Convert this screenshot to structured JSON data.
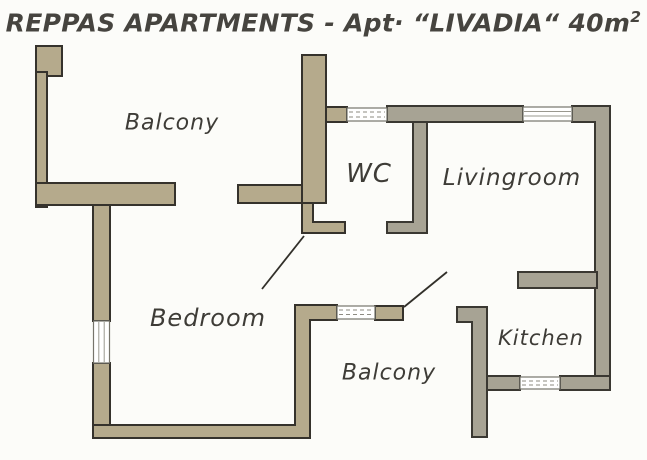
{
  "title": {
    "main": "REPPAS APARTMENTS - Apt· “LIVADIA“ 40m",
    "sup": "2"
  },
  "rooms": [
    {
      "id": "balcony-top",
      "label": "Balcony"
    },
    {
      "id": "wc",
      "label": "WC"
    },
    {
      "id": "livingroom",
      "label": "Livingroom"
    },
    {
      "id": "bedroom",
      "label": "Bedroom"
    },
    {
      "id": "balcony-bottom",
      "label": "Balcony"
    },
    {
      "id": "kitchen",
      "label": "Kitchen"
    }
  ],
  "colors": {
    "wall_khaki": "#b5aa8c",
    "wall_gray": "#a7a394",
    "outline": "#35322c",
    "text": "#3e3c37",
    "background": "#fcfcf9"
  },
  "features": {
    "windows": [
      "wc-window",
      "livingroom-window",
      "bedroom-left-window",
      "bedroom-balcony-window",
      "kitchen-window"
    ],
    "door_openings": [
      "balcony-top-door",
      "wc-door",
      "bedroom-passage-door",
      "balcony-bottom-door"
    ]
  }
}
